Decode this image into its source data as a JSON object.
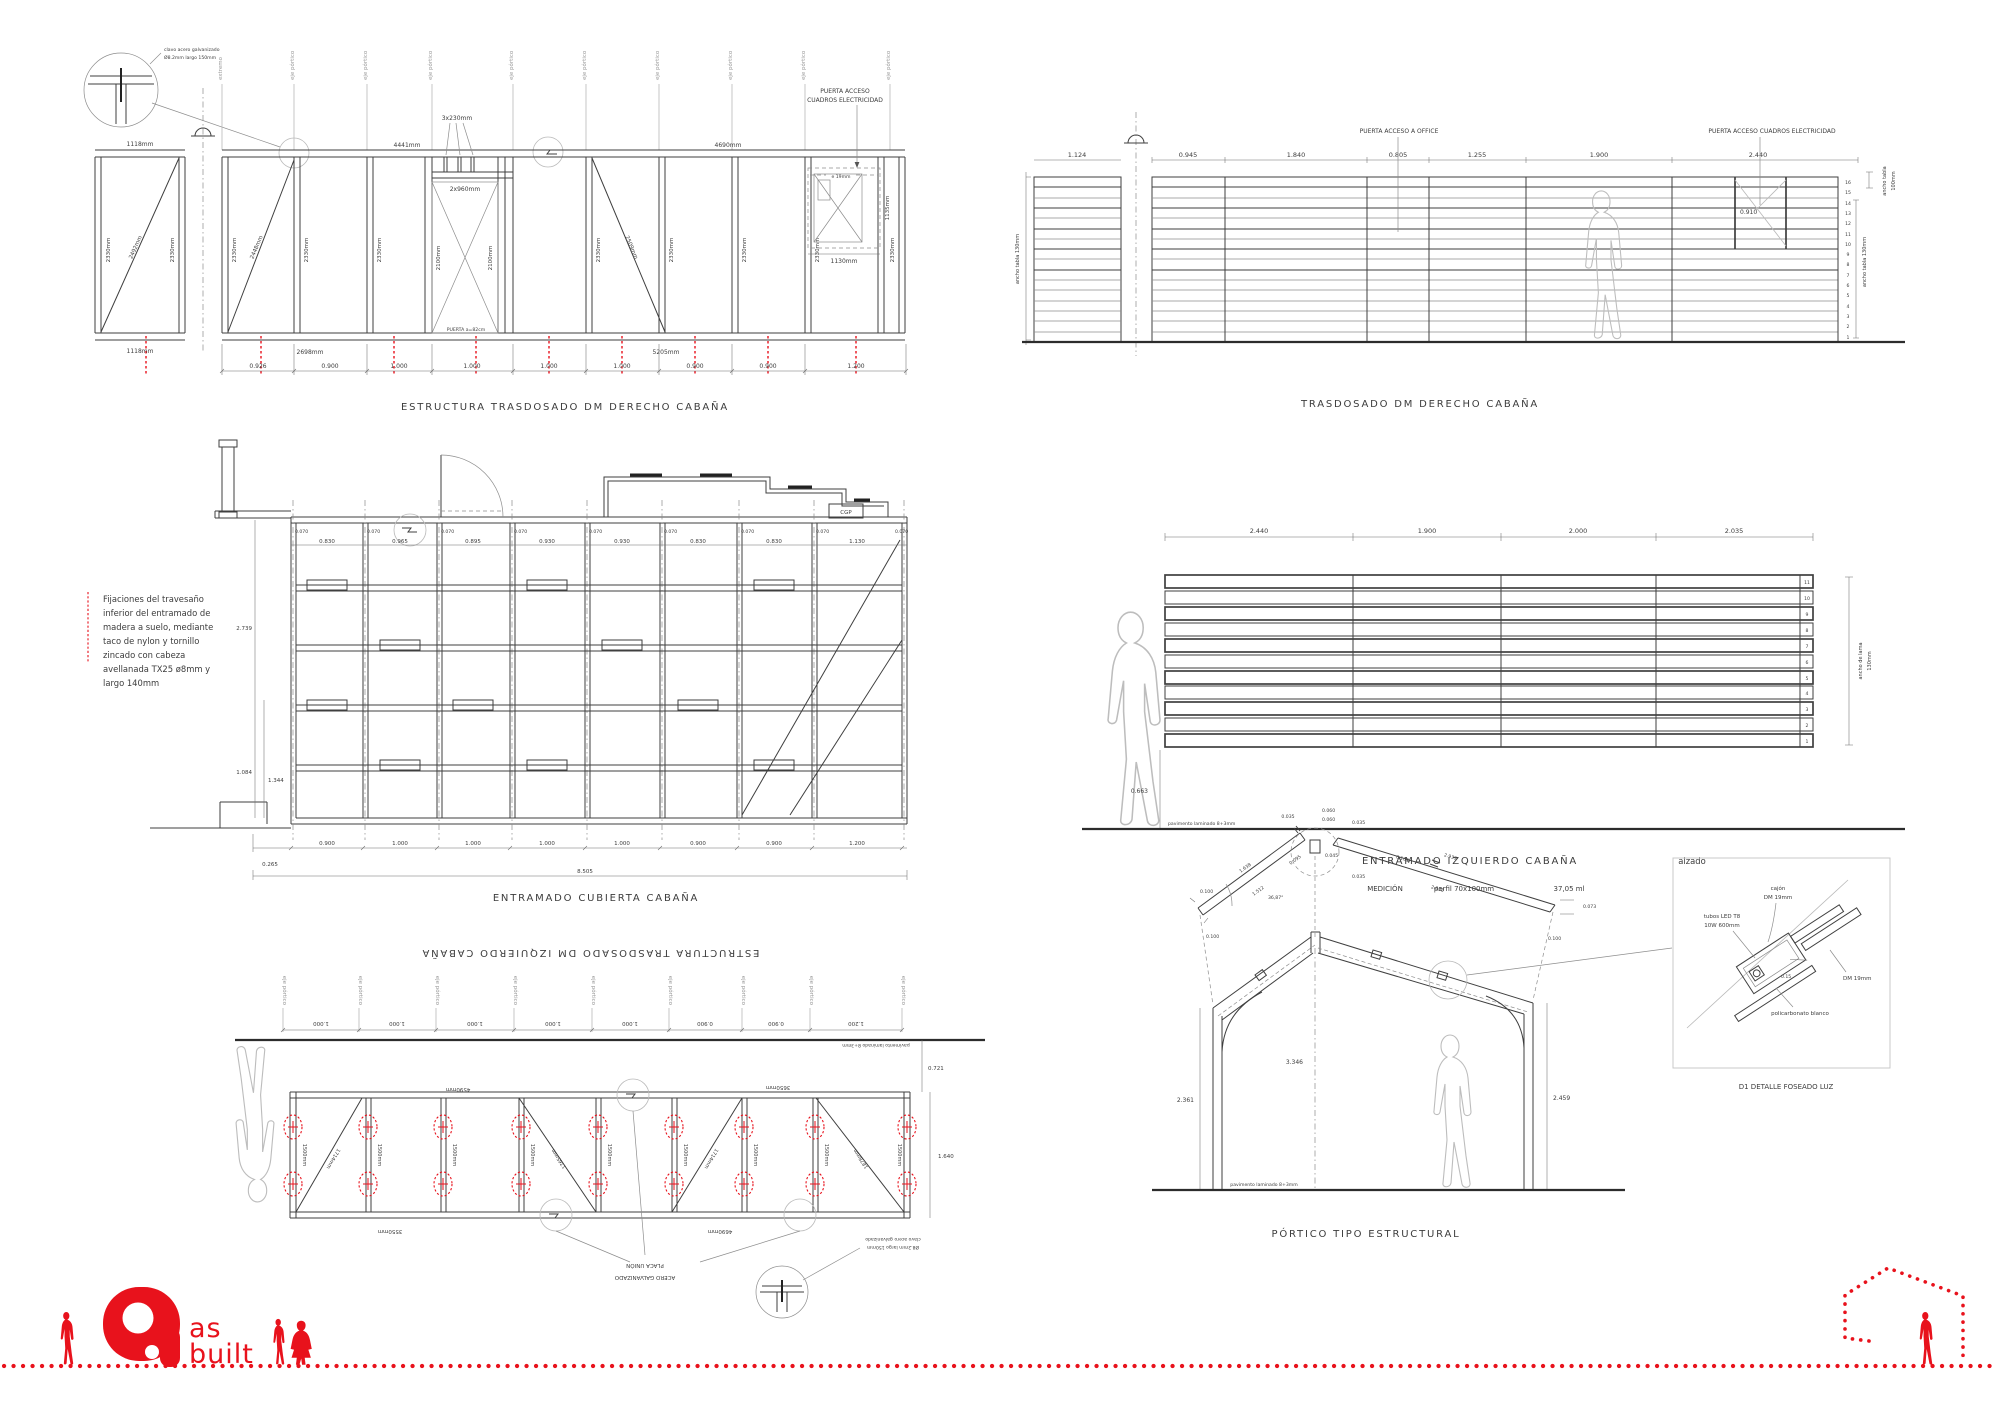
{
  "sheet": {
    "background": "#ffffff",
    "line_color": "#3f3f3f",
    "accent_red": "#e8121c",
    "axis_gray": "#9a9a9a"
  },
  "common": {
    "eje": "eje pórtico",
    "extremo": "extremo",
    "pavimento": "pavimento laminado 8+3mm",
    "clavo_note_l1": "clavo acero galvanizado",
    "clavo_note_l2": "Ø8.2mm largo 150mm",
    "stud2330": "2330mm",
    "stud1500": "1500mm"
  },
  "d1": {
    "title": "ESTRUCTURA  TRASDOSADO  DM  DERECHO  CABAÑA",
    "dim_1118_top": "1118mm",
    "dim_4441": "4441mm",
    "dim_4690": "4690mm",
    "dim_3x230": "3x230mm",
    "dim_2x960": "2x960mm",
    "diag_2492": "2492mm",
    "diag_2448": "2448mm",
    "diag_2509": "2509mm",
    "door_2100": "2100mm",
    "door_label": "PUERTA  a=82cm",
    "elec_l1": "PUERTA  ACCESO",
    "elec_l2": "CUADROS  ELECTRICIDAD",
    "elec_e19": "e 19mm",
    "dim_1135": "1135mm",
    "dim_1130": "1130mm",
    "dim_1118_bot": "1118mm",
    "dim_2698": "2698mm",
    "dim_5205": "5205mm",
    "chain": [
      "0.926",
      "0.900",
      "1.000",
      "1.000",
      "1.000",
      "1.000",
      "0.900",
      "0.900",
      "1.200"
    ]
  },
  "d2": {
    "title": "TRASDOSADO  DM  DERECHO  CABAÑA",
    "dim_1124": "1.124",
    "chain": [
      "0.945",
      "1.840",
      "0.805",
      "1.255",
      "1.900",
      "2.440"
    ],
    "office": "PUERTA  ACCESO  A  OFFICE",
    "elec": "PUERTA  ACCESO  CUADROS  ELECTRICIDAD",
    "dim_0910": "0.910",
    "ancho100_l1": "ancho tabla",
    "ancho100_l2": "100mm",
    "ancho130": "ancho tabla  130mm",
    "rows": [
      "16",
      "15",
      "14",
      "13",
      "12",
      "11",
      "10",
      "9",
      "8",
      "7",
      "6",
      "5",
      "4",
      "3",
      "2",
      "1"
    ]
  },
  "d3": {
    "title": "ENTRAMADO  CUBIERTA  CABAÑA",
    "note": [
      "Fijaciones  del  travesaño",
      "inferior  del  entramado  de",
      "madera  a  suelo,  mediante",
      "taco  de  nylon  y  tornillo",
      "zincado      con      cabeza",
      "avellanada  TX25  ø8mm  y",
      "largo  140mm"
    ],
    "off": "0.070",
    "spans": [
      "0.830",
      "0.965",
      "0.895",
      "0.930",
      "0.930",
      "0.830",
      "0.830",
      "1.130"
    ],
    "dim_2739": "2.739",
    "dim_1084": "1.084",
    "dim_1344": "1.344",
    "chain": [
      "0.900",
      "1.000",
      "1.000",
      "1.000",
      "1.000",
      "0.900",
      "0.900",
      "1.200"
    ],
    "dim_0265": "0.265",
    "total": "8.505",
    "cgp": "CGP"
  },
  "d4": {
    "title": "ENTRAMADO  IZQUIERDO  CABAÑA",
    "alzado": "alzado",
    "med1": "MEDICIÓN",
    "med2": "perfil  70x100mm",
    "med3": "37,05  ml",
    "chain": [
      "2.440",
      "1.900",
      "2.000",
      "2.035"
    ],
    "ancho_l1": "ancho de lama",
    "ancho_l2": "130mm",
    "dim_0663": "0.663",
    "rows": [
      "11",
      "10",
      "9",
      "8",
      "7",
      "6",
      "5",
      "4",
      "3",
      "2",
      "1"
    ]
  },
  "d5": {
    "title": "ESTRUCTURA  TRASDOSADO  DM  IZQUIERDO  CABAÑA",
    "chain": [
      "1.000",
      "1.000",
      "1.000",
      "1.000",
      "1.000",
      "0.900",
      "0.900",
      "1.200"
    ],
    "dim_0721": "0.721",
    "dim_1640": "1.640",
    "diag": [
      "1714mm",
      "1765mm",
      "1714mm",
      "1878mm"
    ],
    "chord_top": [
      "4590mm",
      "3650mm"
    ],
    "chord_bot": [
      "3550mm",
      "4690mm"
    ],
    "placa_l1": "PLACA UNIÓN",
    "placa_l2": "ACERO GALVANIZADO"
  },
  "d6": {
    "title": "PÓRTICO  TIPO  ESTRUCTURAL",
    "dims": {
      "a035": "0.035",
      "a060": "0.060",
      "a045": "0.045",
      "a095": "0.095",
      "l1638": "1.638",
      "l1512": "1.512",
      "l100": "0.100",
      "r2939": "2.939",
      "r2838": "2.838",
      "r073": "0.073",
      "h3346": "3.346",
      "h2361": "2.361",
      "h2459": "2.459",
      "ang": "36,87°"
    }
  },
  "d7": {
    "title": "D1  DETALLE  FOSEADO  LUZ",
    "cajon_l1": "cajón",
    "cajon_l2": "DM  19mm",
    "tubos_l1": "tubos  LED  T8",
    "tubos_l2": "10W  600mm",
    "dm": "DM  19mm",
    "poli": "policarbonato  blanco",
    "dim": "0.15"
  },
  "logo": {
    "as": "as",
    "built": "built"
  }
}
